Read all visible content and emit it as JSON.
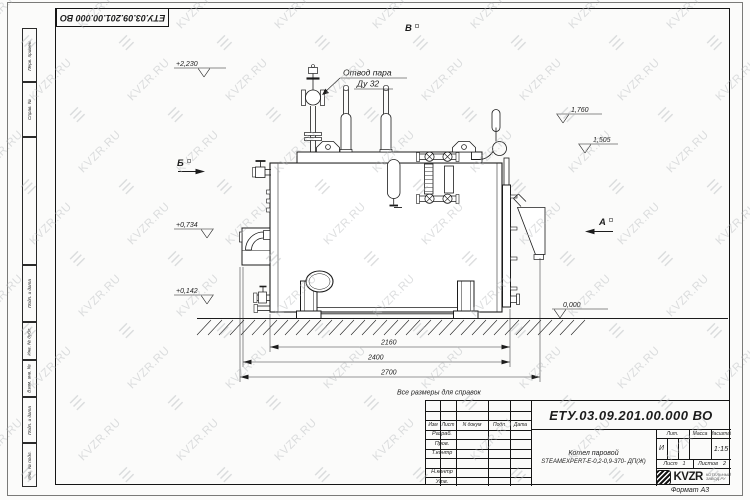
{
  "watermark": {
    "text": "KVZR.RU",
    "logo_glyph": "☰",
    "color": "#b4b7ba"
  },
  "sheet": {
    "corner_number": "ЕТУ.03.09.201.00.000  ВО",
    "format_label": "Формат А3",
    "margin_stamps": [
      "Перв. примен.",
      "Справ. №",
      "Подп. и дата",
      "Инв. № дубл.",
      "Взам. инв. №",
      "Подп. и дата",
      "Инв. № подл."
    ]
  },
  "drawing": {
    "note": "Все размеры для справок",
    "callout_line1": "Отвод пара",
    "callout_line2": "Ду 32",
    "views": {
      "a": "А",
      "b": "Б",
      "v": "В"
    },
    "elevations": {
      "top": "+2,230",
      "upper_right": "1,760",
      "mid_right": "1,505",
      "burner": "+0,734",
      "drain": "+0,142",
      "ground": "0,000"
    },
    "dims": {
      "inner": "2160",
      "middle": "2400",
      "outer": "2700"
    }
  },
  "title_block": {
    "doc_number": "ЕТУ.03.09.201.00.000  ВО",
    "name_line1": "Котел паровой",
    "name_line2": "STEAMEXPERT-E-0,2-0,9-370- ДП(Ж)",
    "col_headers": {
      "izm": "Изм",
      "list": "Лист",
      "doc": "N докум",
      "sign": "Подп",
      "date": "Дата"
    },
    "row_labels": {
      "razrab": "Разраб.",
      "prov": "Пров.",
      "tkontr": "Т.контр",
      "nkontr": "Н.контр",
      "utv": "Утв."
    },
    "lit": {
      "header": "Лит.",
      "value": "И"
    },
    "mass": {
      "header": "Масса",
      "value": ""
    },
    "scale": {
      "header": "Масштаб",
      "value": "1:15"
    },
    "sheet_no": {
      "label": "Лист",
      "value": "1"
    },
    "sheets_total": {
      "label": "Листов",
      "value": "2"
    },
    "logo": {
      "text": "KVZR",
      "sub1": "КОТЕЛЬНЫЙ",
      "sub2": "ЗАВОД.РУ"
    }
  }
}
